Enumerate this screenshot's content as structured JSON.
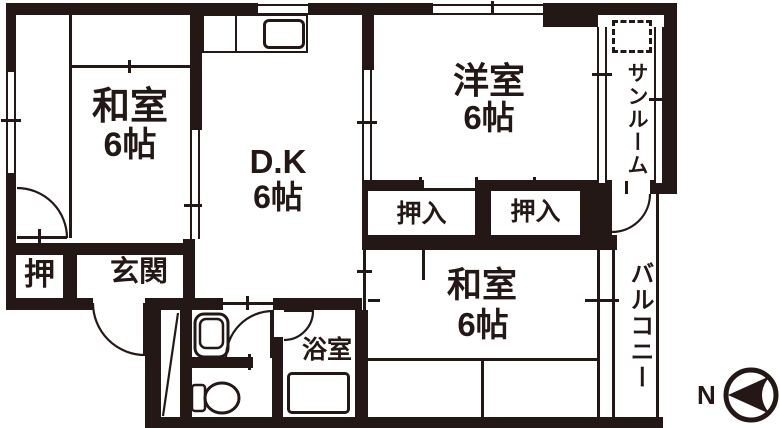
{
  "colors": {
    "ink": "#231815",
    "background": "#ffffff"
  },
  "rooms": {
    "washitsu_top_left": {
      "label": "和室",
      "size": "6帖"
    },
    "dining_kitchen": {
      "label": "D.K",
      "size": "6帖"
    },
    "youshitsu": {
      "label": "洋室",
      "size": "6帖"
    },
    "sunroom": {
      "label": "サンルーム"
    },
    "washitsu_bottom": {
      "label": "和室",
      "size": "6帖"
    },
    "balcony": {
      "label": "バルコニー"
    },
    "genkan": {
      "label": "玄関"
    },
    "oshi_closet": {
      "label": "押"
    },
    "oshiire_left": {
      "label": "押入"
    },
    "oshiire_right": {
      "label": "押入"
    },
    "bathroom": {
      "label": "浴室"
    }
  },
  "compass": {
    "label": "N"
  },
  "icons": [
    "kitchen-sink-icon",
    "washbasin-icon",
    "toilet-icon",
    "bathtub-icon",
    "washer-space-dashed-box",
    "compass-icon"
  ]
}
